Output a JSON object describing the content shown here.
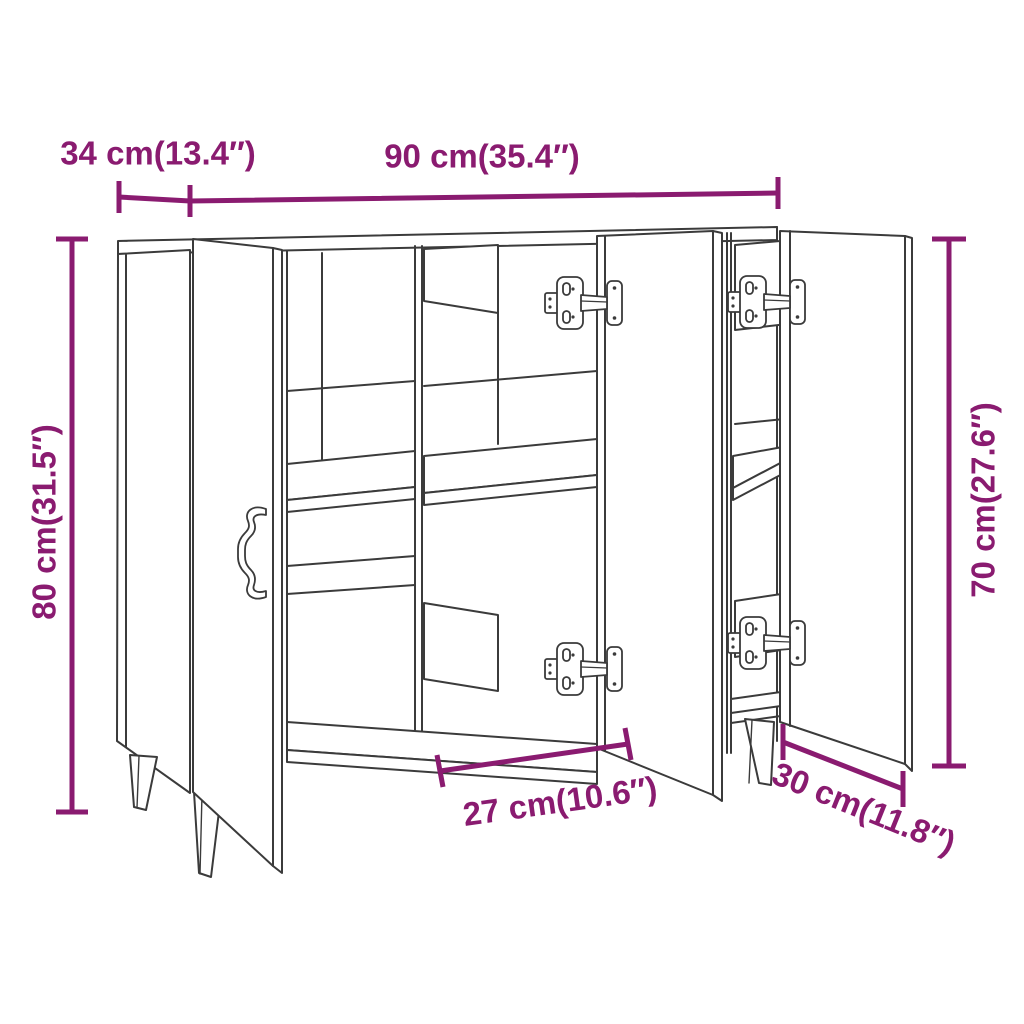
{
  "diagram": {
    "subject": "sideboard-dimension-drawing",
    "colors": {
      "dimension_accent": "#8a1b70",
      "line_art": "#3b3b3b",
      "background": "#ffffff"
    },
    "dimensions": {
      "depth": {
        "label": "34 cm(13.4″)",
        "cm": 34,
        "inches": 13.4
      },
      "width": {
        "label": "90 cm(35.4″)",
        "cm": 90,
        "inches": 35.4
      },
      "height_total": {
        "label": "80 cm(31.5″)",
        "cm": 80,
        "inches": 31.5
      },
      "height_body": {
        "label": "70 cm(27.6″)",
        "cm": 70,
        "inches": 27.6
      },
      "compartment_width": {
        "label": "27 cm(10.6″)",
        "cm": 27,
        "inches": 10.6
      },
      "door_width": {
        "label": "30 cm(11.8″)",
        "cm": 30,
        "inches": 11.8
      }
    }
  }
}
